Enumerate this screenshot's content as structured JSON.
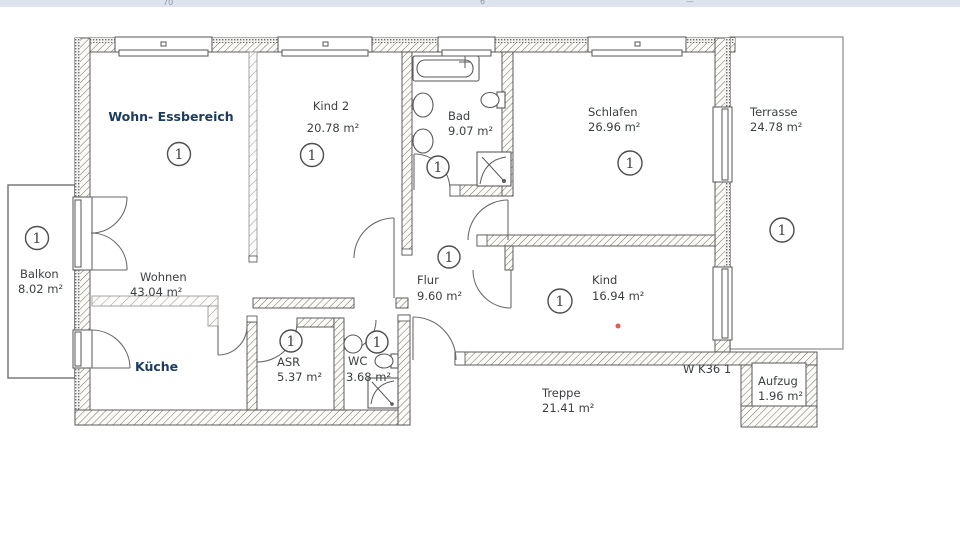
{
  "meta": {
    "marker_glyph": "1",
    "top_fragments": {
      "a": "70",
      "b": "6",
      "c": "—"
    },
    "unit_label": "W K36 1"
  },
  "colors": {
    "navy_label": "#1d3a5f",
    "text": "#3c4043",
    "wall_line": "#4d4d4d",
    "red_dot": "#dd5c5c",
    "top_strip": "#dde4ef"
  },
  "rooms": {
    "wohn_essbereich": {
      "name": "Wohn- Essbereich"
    },
    "kind2": {
      "name": "Kind 2",
      "area": "20.78 m²"
    },
    "bad": {
      "name": "Bad",
      "area": "9.07 m²"
    },
    "schlafen": {
      "name": "Schlafen",
      "area": "26.96 m²"
    },
    "terrasse": {
      "name": "Terrasse",
      "area": "24.78 m²"
    },
    "balkon": {
      "name": "Balkon",
      "area": "8.02 m²"
    },
    "wohnen": {
      "name": "Wohnen",
      "area": "43.04 m²"
    },
    "kueche": {
      "name": "Küche"
    },
    "flur": {
      "name": "Flur",
      "area": "9.60 m²"
    },
    "kind": {
      "name": "Kind",
      "area": "16.94 m²"
    },
    "asr": {
      "name": "ASR",
      "area": "5.37 m²"
    },
    "wc": {
      "name": "WC",
      "area": "3.68 m²"
    },
    "treppe": {
      "name": "Treppe",
      "area": "21.41 m²"
    },
    "aufzug": {
      "name": "Aufzug",
      "area": "1.96 m²"
    }
  }
}
